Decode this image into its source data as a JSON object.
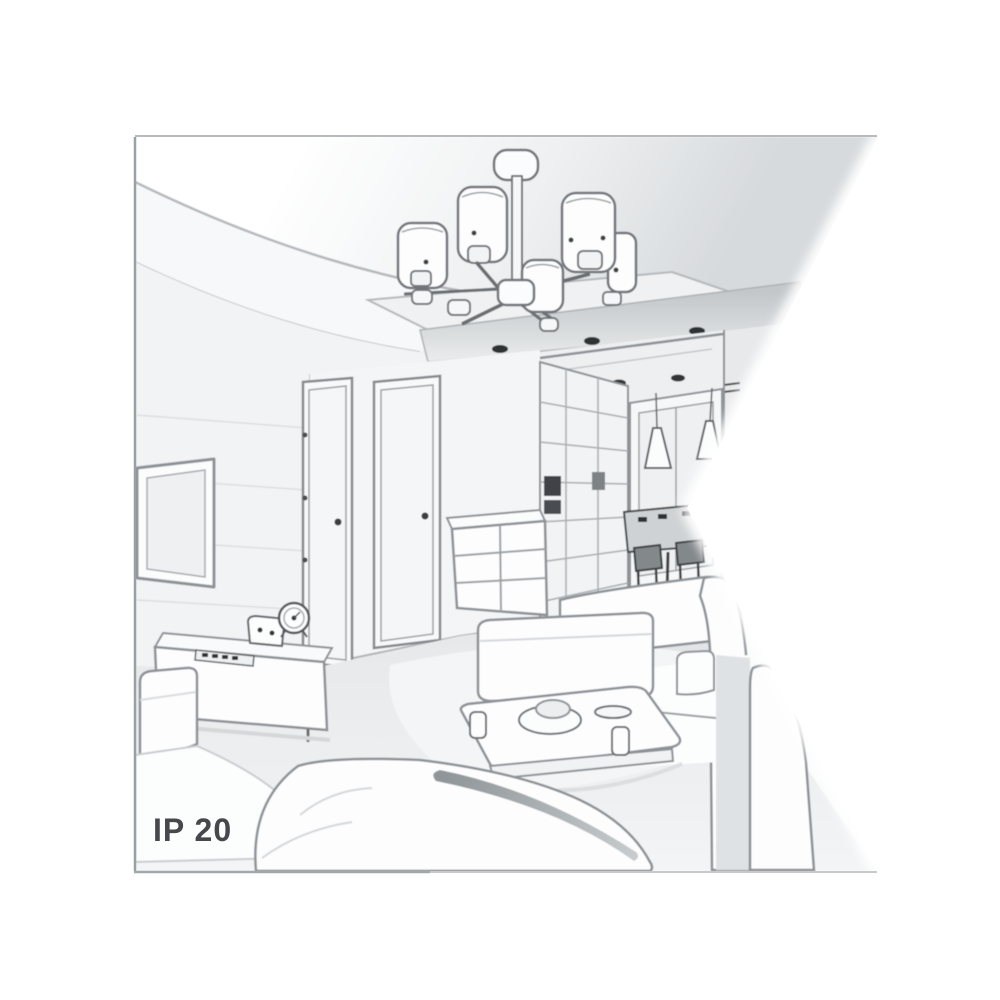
{
  "image": {
    "ip_rating_label": "IP 20"
  },
  "colors": {
    "background": "#ffffff",
    "line_mid": "#8d9296",
    "line_dark": "#55595c",
    "line_light": "#c6cacd",
    "detail_dark": "#2f3335",
    "ceiling_shade": "#d9dcdf",
    "wall": "#f3f5f6",
    "floor": "#e9ebed",
    "label_text": "#46494c"
  },
  "scene": {
    "objects": [
      "ceiling chandelier with six cylindrical shades",
      "recessed ceiling spotlights",
      "wall-mounted tv",
      "tv sideboard with clock and remote",
      "two interior doors",
      "chest of drawers",
      "hallway wardrobe",
      "cone pendant lights",
      "dining table with chairs",
      "coffee table with dishes",
      "white sofas and ottoman"
    ]
  }
}
